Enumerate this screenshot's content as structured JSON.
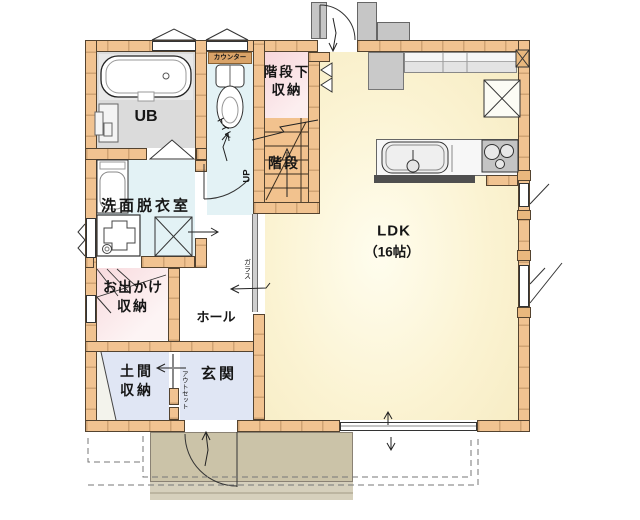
{
  "plan": {
    "title": "1F floor plan",
    "rooms": {
      "ub": {
        "label": "UB"
      },
      "toilet": {
        "label": "トイレ"
      },
      "under_stair_storage": {
        "label": [
          "階段下",
          "収納"
        ]
      },
      "stairs": {
        "label": "階段",
        "direction": "UP"
      },
      "washroom": {
        "label": "洗面脱衣室"
      },
      "outing_storage": {
        "label": [
          "お出かけ",
          "収納"
        ]
      },
      "hall": {
        "label": "ホール"
      },
      "doma_storage": {
        "label": [
          "土間",
          "収納"
        ]
      },
      "entrance": {
        "label": "玄関"
      },
      "ldk": {
        "label": "LDK",
        "size": "（16帖）"
      }
    },
    "fixtures": {
      "counter_label": "カウンター"
    },
    "annotations": {
      "glass": "ガラス",
      "outset": "アウトセット"
    },
    "colors": {
      "wall": "#F1C391",
      "ldk_floor": "#FBF4D6",
      "storage_pink": "#F7D8DC",
      "water_blue": "#E3F2F5",
      "entry_blue": "#E0E6F4",
      "ub_gray": "#DBDBDB",
      "porch": "#CBC3A8",
      "counter_bar": "#D9A368"
    }
  }
}
